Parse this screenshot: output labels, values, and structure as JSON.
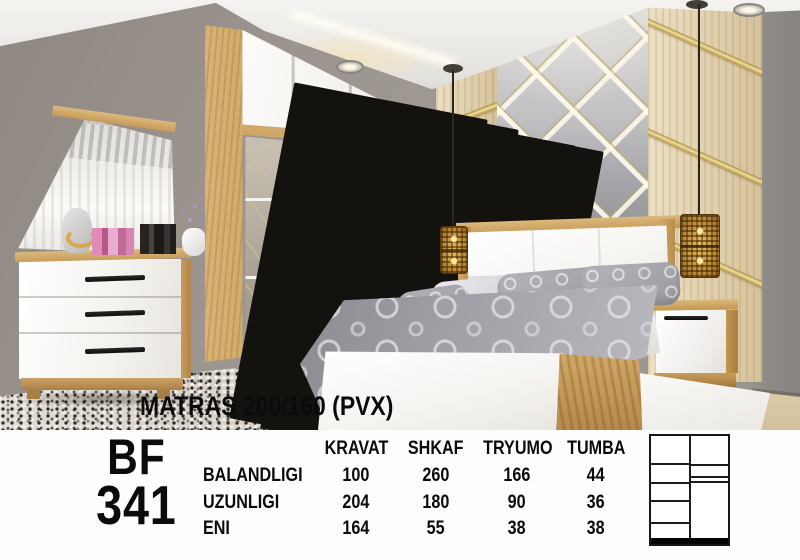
{
  "flyer": {
    "photo_overlay_label": "MATRAS 200/160 (PVX)",
    "model_code": {
      "line1": "BF",
      "line2": "341"
    },
    "spec_table": {
      "columns": [
        "KRAVAT",
        "SHKAF",
        "TRYUMO",
        "TUMBA"
      ],
      "rows": [
        {
          "label": "BALANDLIGI",
          "values": [
            "100",
            "260",
            "166",
            "44"
          ]
        },
        {
          "label": "UZUNLIGI",
          "values": [
            "204",
            "180",
            "90",
            "36"
          ]
        },
        {
          "label": "ENI",
          "values": [
            "164",
            "55",
            "38",
            "38"
          ]
        }
      ]
    },
    "schematic": {
      "type": "wardrobe-front-diagram",
      "left_column_shelves": 5,
      "right_column_top_shelf": 1,
      "base": "solid-black-plinth"
    }
  },
  "scene": {
    "items": [
      "wardrobe-with-mirror-door",
      "double-bed",
      "dresser-with-mirror",
      "nightstand",
      "pendant-lamp-left",
      "pendant-lamp-right",
      "diamond-mirror-accent-wall",
      "shag-rug",
      "jewelry-bust",
      "perfume-bottles",
      "flower-vase"
    ],
    "colors": {
      "wall": "#9b948f",
      "wood": "#c79c58",
      "white_furniture": "#f6f5f2",
      "gold_trim": "#d8bb6a",
      "bedding": "#a3a2a8",
      "floor": "#dccbaa",
      "ceiling": "#ece9e5",
      "band_background": "#fdfdfc",
      "text": "#0b0b0b"
    }
  }
}
